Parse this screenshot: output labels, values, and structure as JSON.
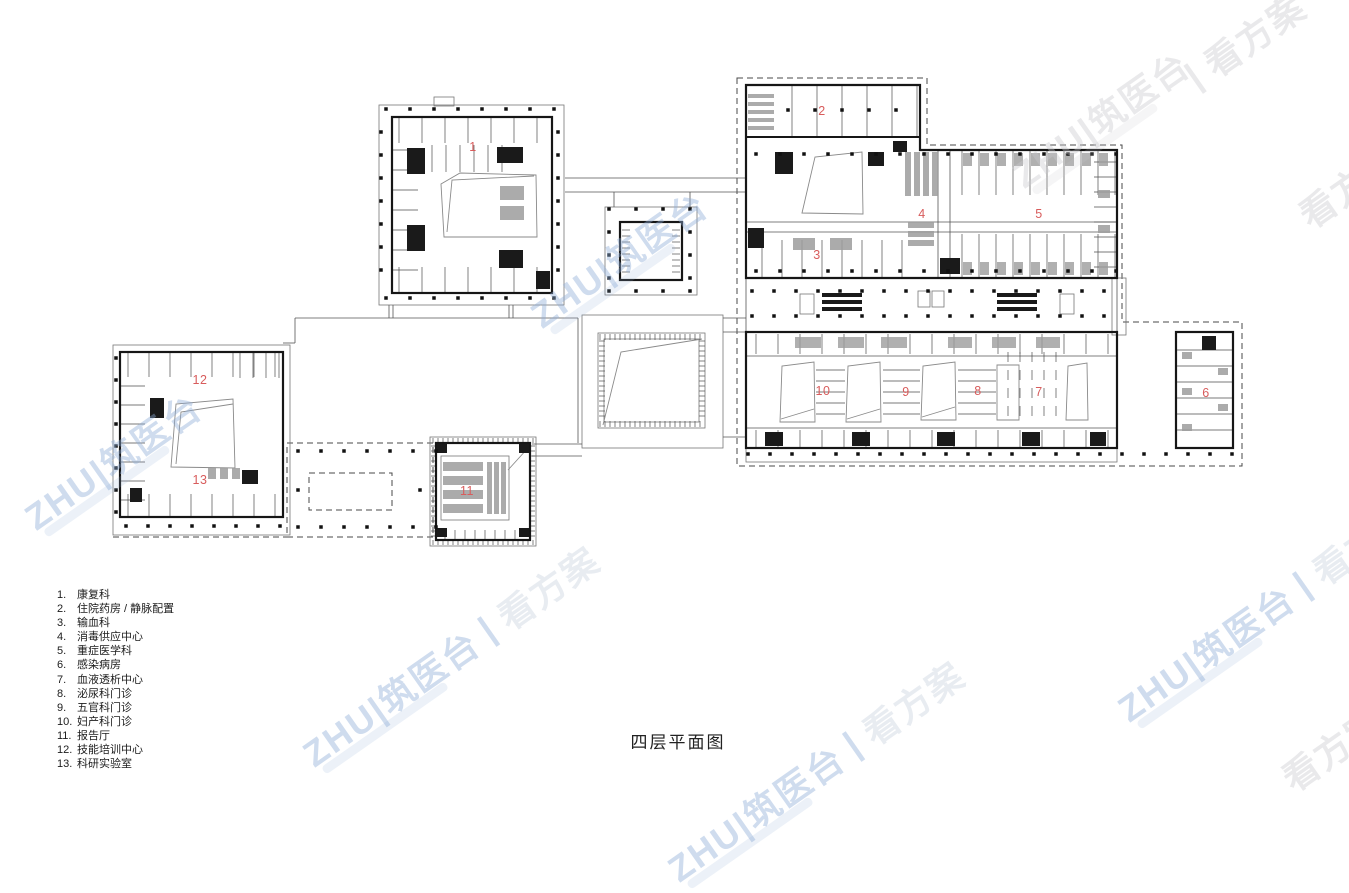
{
  "title": "四层平面图",
  "legend": {
    "items": [
      {
        "num": "1.",
        "label": "康复科"
      },
      {
        "num": "2.",
        "label": "住院药房 / 静脉配置"
      },
      {
        "num": "3.",
        "label": "输血科"
      },
      {
        "num": "4.",
        "label": "消毒供应中心"
      },
      {
        "num": "5.",
        "label": "重症医学科"
      },
      {
        "num": "6.",
        "label": "感染病房"
      },
      {
        "num": "7.",
        "label": "血液透析中心"
      },
      {
        "num": "8.",
        "label": "泌尿科门诊"
      },
      {
        "num": "9.",
        "label": "五官科门诊"
      },
      {
        "num": "10.",
        "label": "妇产科门诊"
      },
      {
        "num": "11.",
        "label": "报告厅"
      },
      {
        "num": "12.",
        "label": "技能培训中心"
      },
      {
        "num": "13.",
        "label": "科研实验室"
      }
    ]
  },
  "plan": {
    "markers": [
      {
        "label": "1",
        "x": 473,
        "y": 147
      },
      {
        "label": "2",
        "x": 822,
        "y": 111
      },
      {
        "label": "3",
        "x": 817,
        "y": 255
      },
      {
        "label": "4",
        "x": 922,
        "y": 214
      },
      {
        "label": "5",
        "x": 1039,
        "y": 214
      },
      {
        "label": "6",
        "x": 1206,
        "y": 393
      },
      {
        "label": "7",
        "x": 1039,
        "y": 392
      },
      {
        "label": "8",
        "x": 978,
        "y": 391
      },
      {
        "label": "9",
        "x": 906,
        "y": 392
      },
      {
        "label": "10",
        "x": 823,
        "y": 391
      },
      {
        "label": "11",
        "x": 467,
        "y": 491
      },
      {
        "label": "12",
        "x": 200,
        "y": 380
      },
      {
        "label": "13",
        "x": 200,
        "y": 480
      }
    ]
  },
  "colors": {
    "marker": "#d85c5c",
    "wall": "#161616",
    "watermark_blue": "#8cacd6",
    "watermark_gray": "#c8c8ce"
  },
  "watermark": {
    "brand": "ZHU|筑医台",
    "separator": "|",
    "phrase": "看方案"
  }
}
